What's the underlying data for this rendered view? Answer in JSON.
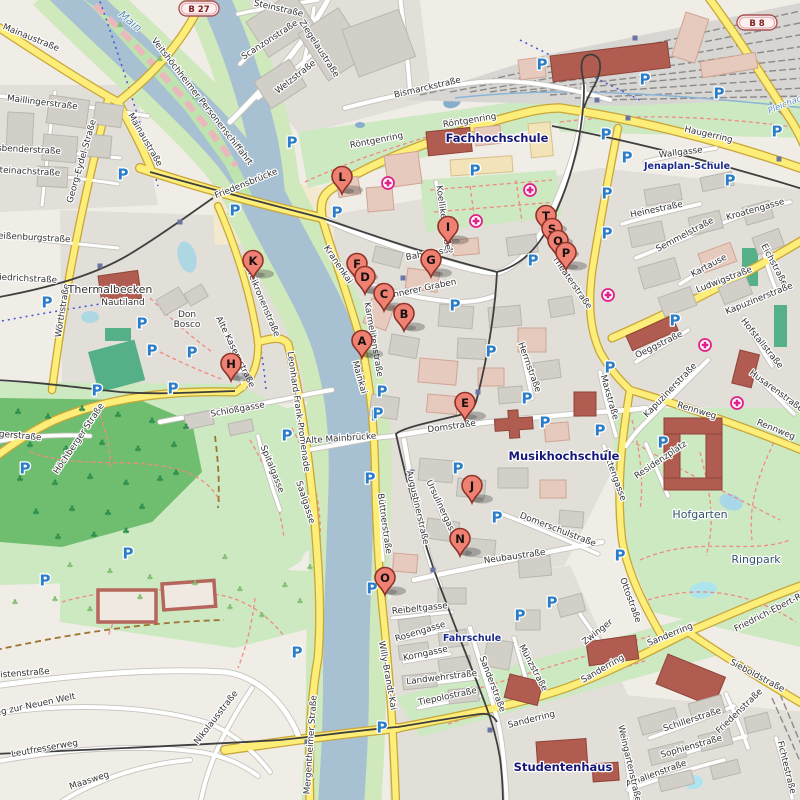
{
  "map": {
    "colors": {
      "land": "#f0ede6",
      "district": "#e2dfd9",
      "water": "#a7c1d3",
      "water_bank": "#cfe8bc",
      "park": "#cde9c1",
      "forest": "#6fbe70",
      "pitch": "#55b087",
      "road_yellow": "#fdee79",
      "road_casing_yellow": "#c9a63a",
      "road_white": "#ffffff",
      "building_gray": "#d2cfc9",
      "building_pink": "#e7cabe",
      "building_civic": "#b05c50",
      "tram": "#3f3f3f",
      "parking": "#2c7dc8",
      "hospital": "#e0218a",
      "marker_fill": "#ef8173",
      "marker_stroke": "#8e3328"
    },
    "route_badges": [
      {
        "label": "B 27",
        "x": 199,
        "y": 9
      },
      {
        "label": "B 8",
        "x": 757,
        "y": 23
      }
    ],
    "markers": [
      {
        "letter": "A",
        "x": 362,
        "y": 341
      },
      {
        "letter": "B",
        "x": 404,
        "y": 314
      },
      {
        "letter": "C",
        "x": 384,
        "y": 294
      },
      {
        "letter": "D",
        "x": 365,
        "y": 277
      },
      {
        "letter": "E",
        "x": 465,
        "y": 403
      },
      {
        "letter": "F",
        "x": 357,
        "y": 264
      },
      {
        "letter": "G",
        "x": 431,
        "y": 260
      },
      {
        "letter": "H",
        "x": 231,
        "y": 364
      },
      {
        "letter": "I",
        "x": 448,
        "y": 227
      },
      {
        "letter": "J",
        "x": 472,
        "y": 486
      },
      {
        "letter": "K",
        "x": 253,
        "y": 261
      },
      {
        "letter": "L",
        "x": 342,
        "y": 177
      },
      {
        "letter": "N",
        "x": 460,
        "y": 539
      },
      {
        "letter": "O",
        "x": 385,
        "y": 578
      },
      {
        "letter": "T",
        "x": 546,
        "y": 216
      },
      {
        "letter": "S",
        "x": 552,
        "y": 229
      },
      {
        "letter": "Q",
        "x": 558,
        "y": 241
      },
      {
        "letter": "P",
        "x": 566,
        "y": 253
      }
    ],
    "street_labels": [
      [
        "Mainaustraße",
        30,
        40,
        22
      ],
      [
        "Mainaustraße",
        143,
        141,
        60
      ],
      [
        "Maillingerstraße",
        42,
        105,
        7
      ],
      [
        "Fasbenderstraße",
        24,
        152,
        3
      ],
      [
        "Steinachstraße",
        27,
        174,
        3
      ],
      [
        "Weißenburgstraße",
        30,
        240,
        3
      ],
      [
        "Friedrichstraße",
        24,
        281,
        3
      ],
      [
        "Georg-Eydel-Straße",
        84,
        162,
        -74
      ],
      [
        "Wörthstraße",
        65,
        311,
        -81
      ],
      [
        "Jägerstraße",
        16,
        438,
        5
      ],
      [
        "Höchberger Straße",
        81,
        440,
        -56
      ],
      [
        "Veitshöchheimer Personenschiffahrt",
        200,
        103,
        52
      ],
      [
        "Friedensbrücke",
        247,
        186,
        -22
      ],
      [
        "Steinstraße",
        278,
        11,
        13
      ],
      [
        "Scanzonstraße",
        271,
        42,
        -33
      ],
      [
        "Ziegelaustraße",
        317,
        50,
        57
      ],
      [
        "Welzstraße",
        297,
        79,
        -38
      ],
      [
        "Bismarckstraße",
        428,
        90,
        -13
      ],
      [
        "Röntgenring",
        377,
        143,
        -11
      ],
      [
        "Röntgenring",
        470,
        123,
        -9
      ],
      [
        "Haugerring",
        708,
        137,
        13
      ],
      [
        "Wallgasse",
        681,
        155,
        -7
      ],
      [
        "Dreikronenstraße",
        260,
        302,
        67
      ],
      [
        "Alte Kasernstraße",
        233,
        353,
        64
      ],
      [
        "Kranenkai",
        336,
        266,
        56
      ],
      [
        "Karmelitenstraße",
        371,
        340,
        80
      ],
      [
        "Mainkai",
        357,
        378,
        74
      ],
      [
        "Leonhard-Frank-Promenade",
        296,
        412,
        82
      ],
      [
        "Saalgasse",
        303,
        503,
        72
      ],
      [
        "Spitalgasse",
        270,
        470,
        68
      ],
      [
        "Schloßgasse",
        238,
        412,
        -10
      ],
      [
        "Alte Mainbrücke",
        341,
        441,
        -4
      ],
      [
        "Büttnerstraße",
        382,
        524,
        82
      ],
      [
        "Augustinerstraße",
        415,
        508,
        77
      ],
      [
        "Ursulinergasse",
        440,
        511,
        65
      ],
      [
        "Innerer Graben",
        424,
        291,
        -12
      ],
      [
        "Bahngasse",
        430,
        256,
        -10
      ],
      [
        "Koellikerstraße",
        441,
        218,
        82
      ],
      [
        "Domstraße",
        452,
        429,
        -8
      ],
      [
        "Herrnstraße",
        527,
        368,
        70
      ],
      [
        "Maxstraße",
        607,
        398,
        74
      ],
      [
        "Theaterstraße",
        570,
        284,
        55
      ],
      [
        "Heinestraße",
        657,
        212,
        -12
      ],
      [
        "Semmelstraße",
        686,
        237,
        -28
      ],
      [
        "Kroatengasse",
        756,
        212,
        -16
      ],
      [
        "Kartause",
        710,
        268,
        -28
      ],
      [
        "Ludwigstraße",
        725,
        282,
        -21
      ],
      [
        "Eichstraße",
        772,
        266,
        62
      ],
      [
        "Kapuzinerstraße",
        760,
        301,
        -22
      ],
      [
        "Kapuzinerstraße",
        672,
        392,
        -46
      ],
      [
        "Oeggstraße",
        660,
        347,
        -26
      ],
      [
        "Hofstallstraße",
        760,
        345,
        51
      ],
      [
        "Husarenstraße",
        775,
        393,
        36
      ],
      [
        "Rennweg",
        696,
        413,
        17
      ],
      [
        "Rennweg",
        775,
        432,
        22
      ],
      [
        "Kettengasse",
        612,
        476,
        70
      ],
      [
        "Residenzplatz",
        662,
        462,
        -34
      ],
      [
        "Ottostraße",
        628,
        601,
        70
      ],
      [
        "Sanderring",
        671,
        637,
        -22
      ],
      [
        "Sanderring",
        604,
        671,
        -30
      ],
      [
        "Sanderring",
        532,
        722,
        -14
      ],
      [
        "Zwinger",
        599,
        634,
        -38
      ],
      [
        "Sieboldstraße",
        756,
        678,
        28
      ],
      [
        "Friedrich-Ebert-Ring",
        775,
        612,
        -27
      ],
      [
        "Schillerstraße",
        693,
        722,
        -18
      ],
      [
        "Friedenstraße",
        741,
        713,
        -44
      ],
      [
        "Sophienstraße",
        692,
        749,
        -16
      ],
      [
        "Amalienstraße",
        657,
        776,
        -20
      ],
      [
        "Weingartenstraße",
        627,
        764,
        77
      ],
      [
        "Fichtestraße",
        784,
        768,
        76
      ],
      [
        "Münzstraße",
        531,
        669,
        62
      ],
      [
        "Sanderstraße",
        490,
        685,
        69
      ],
      [
        "Neubaustraße",
        515,
        559,
        -8
      ],
      [
        "Domerschulstraße",
        557,
        532,
        21
      ],
      [
        "Reibeltgasse",
        420,
        611,
        -6
      ],
      [
        "Rosengasse",
        421,
        634,
        -17
      ],
      [
        "Korngasse",
        426,
        656,
        -12
      ],
      [
        "Landwehrstraße",
        442,
        680,
        -7
      ],
      [
        "Tiepolostraße",
        448,
        699,
        -12
      ],
      [
        "Willy-Brandt-Kai",
        385,
        676,
        80
      ],
      [
        "Mergentheimer Straße",
        313,
        745,
        -86
      ],
      [
        "Leistenstraße",
        20,
        676,
        -4
      ],
      [
        "Weg zur Neuen Welt",
        32,
        708,
        -12
      ],
      [
        "Leutfresserweg",
        45,
        751,
        -10
      ],
      [
        "Maasweg",
        90,
        783,
        -18
      ],
      [
        "Nikolausstraße",
        218,
        719,
        -52
      ]
    ],
    "area_labels": [
      [
        "Fachhochschule",
        497,
        142
      ],
      [
        "Musikhochschule",
        564,
        460
      ],
      [
        "Studentenhaus",
        563,
        771
      ]
    ],
    "school_labels": [
      [
        "Jenaplan-Schule",
        687,
        169
      ],
      [
        "Fahrschule",
        472,
        641
      ]
    ],
    "park_labels": [
      [
        "Hofgarten",
        700,
        518
      ],
      [
        "Ringpark",
        756,
        563
      ]
    ],
    "water_labels": [
      [
        "Main",
        128,
        24,
        40
      ],
      [
        "Pleichach",
        788,
        106,
        -22
      ]
    ],
    "poi_labels": [
      [
        "Thermalbecken",
        110,
        293,
        "#79bede",
        11
      ],
      [
        "Nautiland",
        123,
        305,
        "#222222",
        9
      ],
      [
        "Don",
        187,
        317,
        "#222222",
        9
      ],
      [
        "Bosco",
        187,
        327,
        "#222222",
        9
      ]
    ],
    "parking_icons": [
      [
        123,
        174
      ],
      [
        292,
        142
      ],
      [
        337,
        212
      ],
      [
        475,
        170
      ],
      [
        533,
        260
      ],
      [
        455,
        305
      ],
      [
        491,
        351
      ],
      [
        607,
        193
      ],
      [
        607,
        233
      ],
      [
        730,
        180
      ],
      [
        675,
        320
      ],
      [
        610,
        367
      ],
      [
        645,
        79
      ],
      [
        542,
        64
      ],
      [
        719,
        93
      ],
      [
        777,
        131
      ],
      [
        606,
        134
      ],
      [
        627,
        157
      ],
      [
        47,
        302
      ],
      [
        142,
        323
      ],
      [
        152,
        350
      ],
      [
        192,
        352
      ],
      [
        235,
        210
      ],
      [
        97,
        390
      ],
      [
        173,
        388
      ],
      [
        25,
        468
      ],
      [
        128,
        553
      ],
      [
        45,
        580
      ],
      [
        287,
        435
      ],
      [
        376,
        415
      ],
      [
        370,
        478
      ],
      [
        382,
        391
      ],
      [
        378,
        413
      ],
      [
        527,
        398
      ],
      [
        545,
        422
      ],
      [
        600,
        430
      ],
      [
        458,
        468
      ],
      [
        497,
        517
      ],
      [
        372,
        588
      ],
      [
        520,
        615
      ],
      [
        552,
        602
      ],
      [
        382,
        727
      ],
      [
        297,
        652
      ],
      [
        663,
        442
      ],
      [
        620,
        555
      ]
    ],
    "hospital_icons": [
      [
        388,
        183
      ],
      [
        476,
        221
      ],
      [
        530,
        190
      ],
      [
        608,
        295
      ],
      [
        705,
        345
      ],
      [
        737,
        403
      ]
    ],
    "tram_stops": [
      [
        180,
        222
      ],
      [
        100,
        266
      ],
      [
        403,
        278
      ],
      [
        478,
        392
      ],
      [
        412,
        472
      ],
      [
        433,
        570
      ],
      [
        490,
        730
      ],
      [
        635,
        38
      ],
      [
        597,
        100
      ],
      [
        628,
        118
      ],
      [
        779,
        159
      ],
      [
        307,
        742
      ]
    ]
  }
}
